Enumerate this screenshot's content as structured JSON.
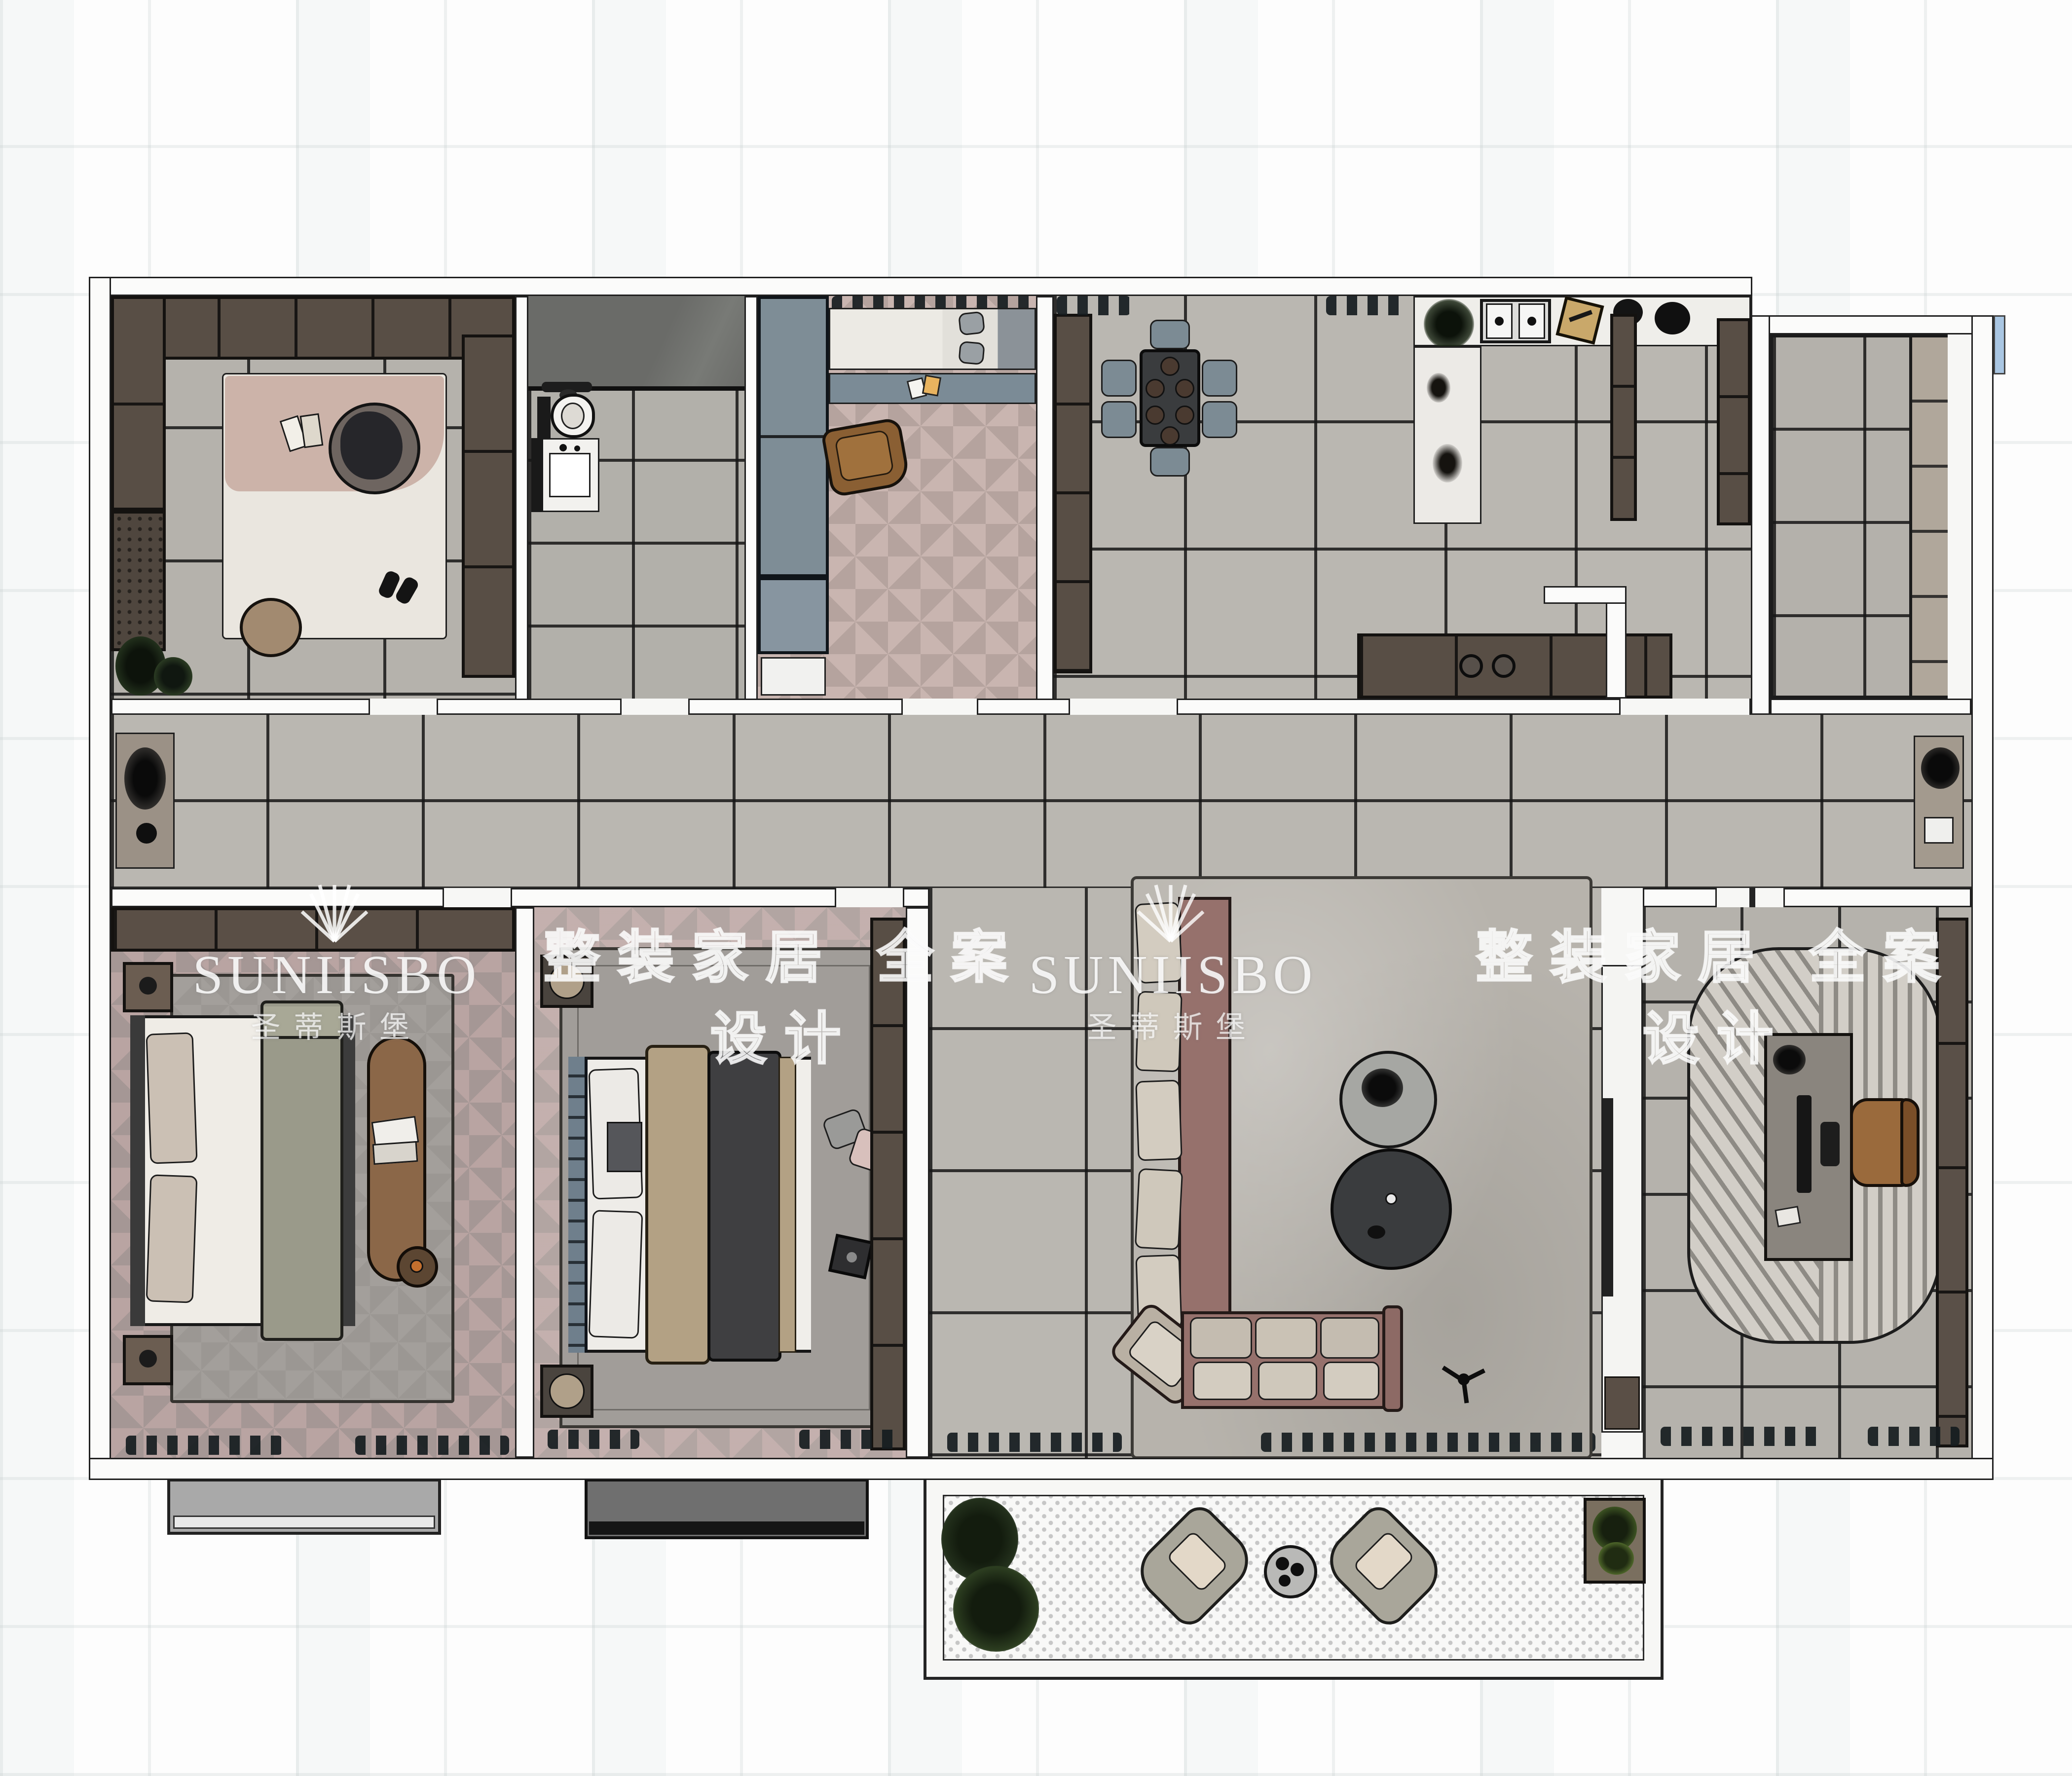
{
  "watermarks": {
    "brand": "SUNIISBO",
    "brand_cn": "圣蒂斯堡",
    "slogan": "整装家居 全案设计"
  },
  "palette": {
    "floor_marble_gray": "#b8b5af",
    "floor_marble_light": "#c2bfb8",
    "bath_marble_dark": "#6a6b68",
    "herringbone_master": "#a59795",
    "herringbone_guest": "#b2a5a2",
    "cabinet_brown": "#584e45",
    "wardrobe_blue_gray": "#7e8d96",
    "dining_table_dark": "#3a3c3e",
    "chair_blue_gray": "#7c8b94",
    "sofa_mauve": "#96716c",
    "sofa_cushion_beige": "#d3ccc0",
    "blanket_olive": "#9a9a8a",
    "duvet_charcoal": "#3f3f41",
    "blanket_tan": "#b3a184",
    "lounge_wood_brown": "#8a5f33",
    "rug_gray": "#b7b3ac",
    "study_rug": "#d2cec7",
    "balcony_dot": "#c6c6c6",
    "bay_light": "#a9a9a9",
    "bay_dark": "#6f6f6f",
    "watermark_white": "#ffffff"
  }
}
